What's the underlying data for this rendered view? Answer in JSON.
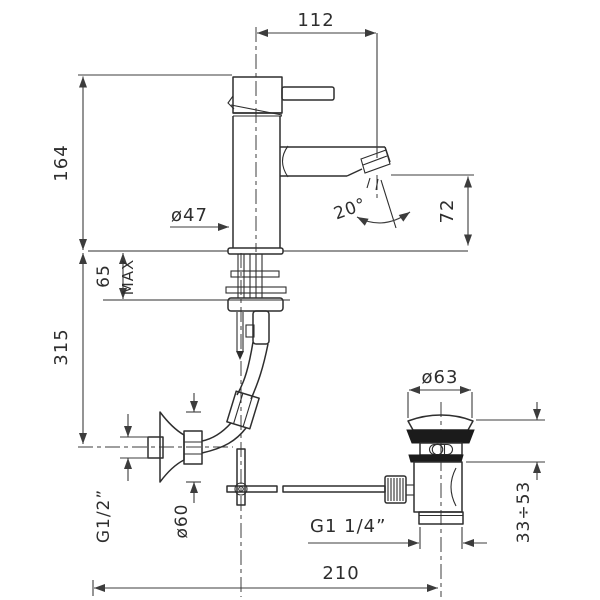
{
  "drawing": {
    "kind": "technical-dimension-drawing",
    "subject": "single-lever basin mixer with pop-up waste",
    "units": "mm",
    "colors": {
      "line": "#2e2e2e",
      "dimension": "#3c3c3c",
      "gasket_fill": "#1b1b1b",
      "background": "#ffffff"
    }
  },
  "dimensions": {
    "spout_reach": "112",
    "spout_height": "164",
    "body_diameter": "ø47",
    "stream_angle": "20°",
    "outlet_height": "72",
    "deck_thickness_value": "65",
    "deck_thickness_qualifier": "MAX",
    "supply_height": "315",
    "supply_thread": "G1/2”",
    "supply_flange_diameter": "ø60",
    "waste_thread": "G1  1/4”",
    "drain_offset": "210",
    "waste_flange_diameter": "ø63",
    "basin_thickness_range": "33÷53"
  }
}
